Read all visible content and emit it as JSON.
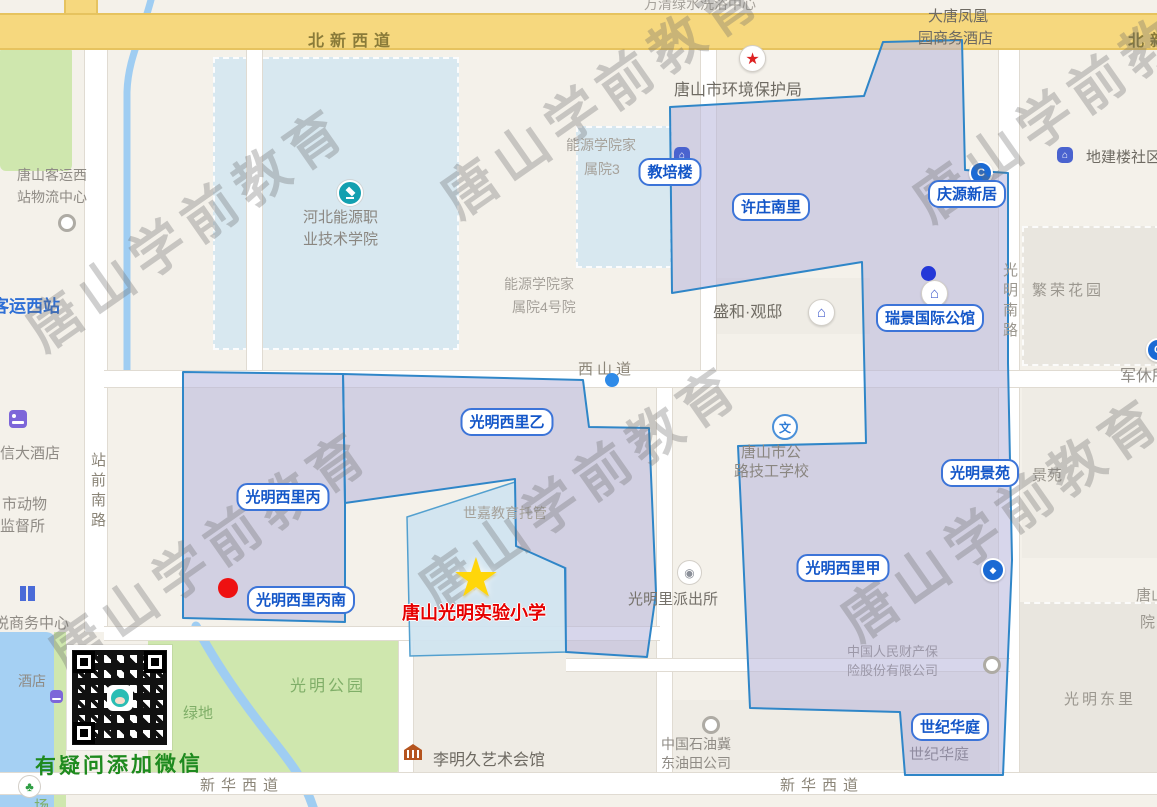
{
  "watermark": {
    "text": "唐山学前教育"
  },
  "wechat": {
    "note": "有疑问添加微信"
  },
  "school": {
    "name": "唐山光明实验小学"
  },
  "roads": {
    "beixinxidao": "北新西道",
    "beixinxidao_right": "北新西道",
    "xishandao": "西山道",
    "xinhuaxidao_left": "新华西道",
    "xinhuaxidao_right": "新华西道",
    "zhanqiannanlu": "站前南路",
    "guangmingnanlu": "光明南路"
  },
  "pills": {
    "jiaopeilou": "教培楼",
    "xuzhuangnanli": "许庄南里",
    "qingyuanxinju": "庆源新居",
    "ruijing": "瑞景国际公馆",
    "xiliyi": "光明西里乙",
    "xilibing": "光明西里丙",
    "xilibingnan": "光明西里丙南",
    "xilijia": "光明西里甲",
    "jingyuan": "光明景苑",
    "shijihuating": "世纪华庭"
  },
  "areas": {
    "wanqing": "万清绿水洗浴中心",
    "datang_line1": "大唐凤凰",
    "datang_line2": "园商务酒店",
    "huanbaoju": "唐山市环境保护局",
    "dijianlou": "地建楼社区",
    "fanronghuayuan": "繁荣花园",
    "nengyuan3_line1": "能源学院家",
    "nengyuan3_line2": "属院3",
    "hebei_line1": "河北能源职",
    "hebei_line2": "业技术学院",
    "keyun_line1": "唐山客运西",
    "keyun_line2": "站物流中心",
    "keyunxizhan": "客运西站",
    "shenghe": "盛和·观邸",
    "nengyuan4_line1": "能源学院家",
    "nengyuan4_line2": "属院4号院",
    "junxiusuo": "军休所",
    "xindajiudian": "信大酒店",
    "shidongwu_line1": "市动物",
    "shidongwu_line2": "监督所",
    "gonglu_line1": "唐山市公",
    "gonglu_line2": "路技工学校",
    "shijia": "世嘉教育托管",
    "paichusuo": "光明里派出所",
    "jingyuan_gray": "景苑",
    "picc_line1": "中国人民财产保",
    "picc_line2": "险股份有限公司",
    "yueshangwu": "悦商务中心",
    "jiudian": "酒店",
    "guangminggongyuan": "光明公园",
    "lvdi": "绿地",
    "guangmingdongli": "光明东里",
    "tangshan_fragment": "唐山",
    "yuan_fragment": "院",
    "chang_fragment": "场",
    "shijihuating_gray": "世纪华庭",
    "shiyou_line1": "中国石油冀",
    "shiyou_line2": "东油田公司",
    "liming": "李明久艺术会馆"
  },
  "icons": {
    "wen": "文",
    "house": "⌂",
    "bank_c": "C",
    "diamond": "◆",
    "badge": "◉",
    "star": "★",
    "tree": "♣"
  },
  "regions": {
    "east": {
      "points": "883,42 962,40 965,170 1008,173 1008,363 1012,560 1003,775 905,775 900,712 750,708 742,530 738,446 866,443 862,262 672,293 670,107 864,96"
    },
    "west_yi": {
      "points": "343,374 583,380 589,427 649,428 656,593 647,657 566,652 565,568 516,546 515,479 345,503"
    },
    "west_bing": {
      "points": "183,372 343,374 345,503 345,622 183,618"
    },
    "school_block": {
      "points": "407,517 515,482 516,546 566,568 566,652 410,656"
    }
  },
  "colors": {
    "region_fill": "#b6b4da",
    "region_stroke": "#2f86c8",
    "pill_blue": "#1356c8",
    "school_red": "#e60000",
    "star_yellow": "#ffd60a",
    "wechat_green": "#1e8a1e",
    "road_yellow": "#f6d87e"
  }
}
